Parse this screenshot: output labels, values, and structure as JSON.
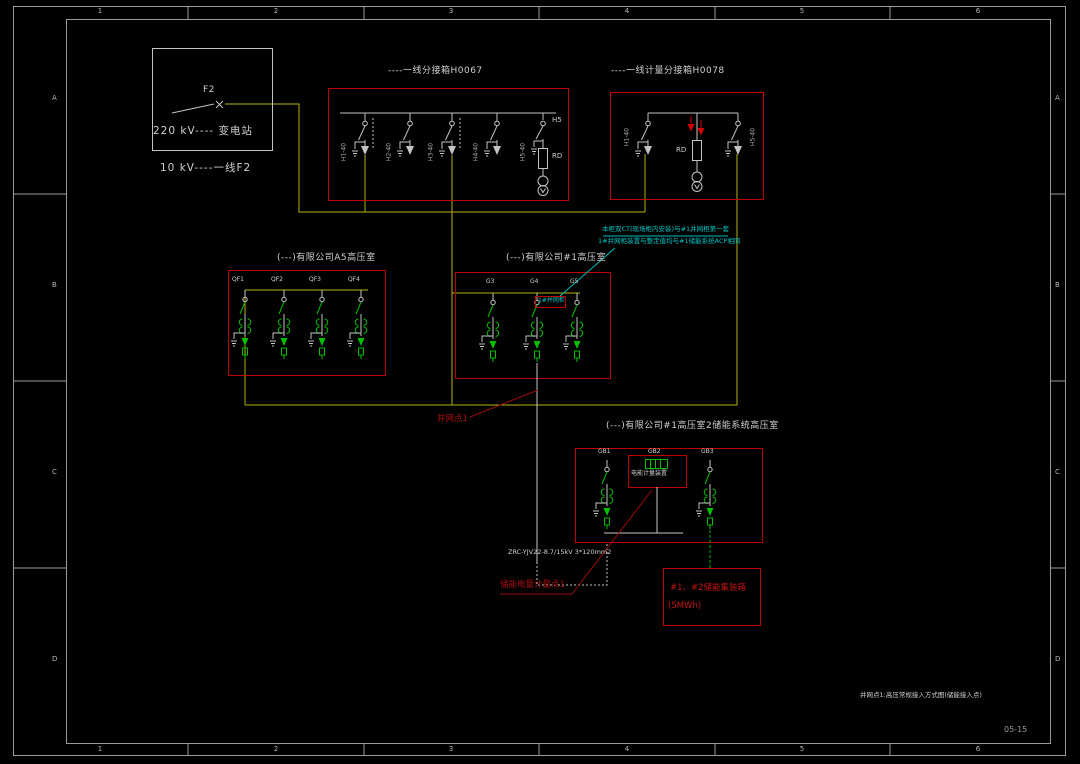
{
  "frame": {
    "zones_top": [
      "1",
      "2",
      "3",
      "4",
      "5",
      "6"
    ],
    "zones_side": [
      "A",
      "B",
      "C",
      "D"
    ],
    "note": "并网点1:高压常规接入方式图(储能接入点)",
    "sheet_no": "05-15"
  },
  "substation": {
    "breaker": "F2",
    "station": "220 kV---- 变电站",
    "feeder": "10 kV----一线F2"
  },
  "h0067": {
    "title": "----一线分接箱H0067",
    "bays": [
      "H1-40",
      "H2-40",
      "H3-40",
      "H4-40",
      "H5-40"
    ],
    "switch": "H5",
    "fuse": "RD"
  },
  "h0078": {
    "title": "----一线计量分接箱H0078",
    "left_bay": "H1-40",
    "right_bay": "H5-40",
    "fuse": "RD"
  },
  "room_a5": {
    "title": "(---)有限公司A5高压室",
    "bays": [
      "QF1",
      "QF2",
      "QF3",
      "QF4"
    ]
  },
  "room_1": {
    "title": "(---)有限公司#1高压室",
    "bays": [
      "G3",
      "G4",
      "G5"
    ],
    "cabinet": "1#并网柜"
  },
  "note_cyan": {
    "line1": "本柜双CT(现场柜内安装)与#1并网柜第一套",
    "line2": "1#并网柜装置与整定值均与#1储能系统ACP相同"
  },
  "grid_point": "并网点1",
  "cable": "ZRC-YJV22-8.7/15kV 3*120mm2",
  "meter_point": "储能电量计量点1",
  "storage_room": {
    "title": "(---)有限公司#1高压室2储能系统高压室",
    "bays": [
      "GB1",
      "GB2",
      "GB3"
    ],
    "meter": "电能计量装置"
  },
  "storage": {
    "line1": "#1、#2储能集装箱",
    "line2": "(5MWh)"
  }
}
